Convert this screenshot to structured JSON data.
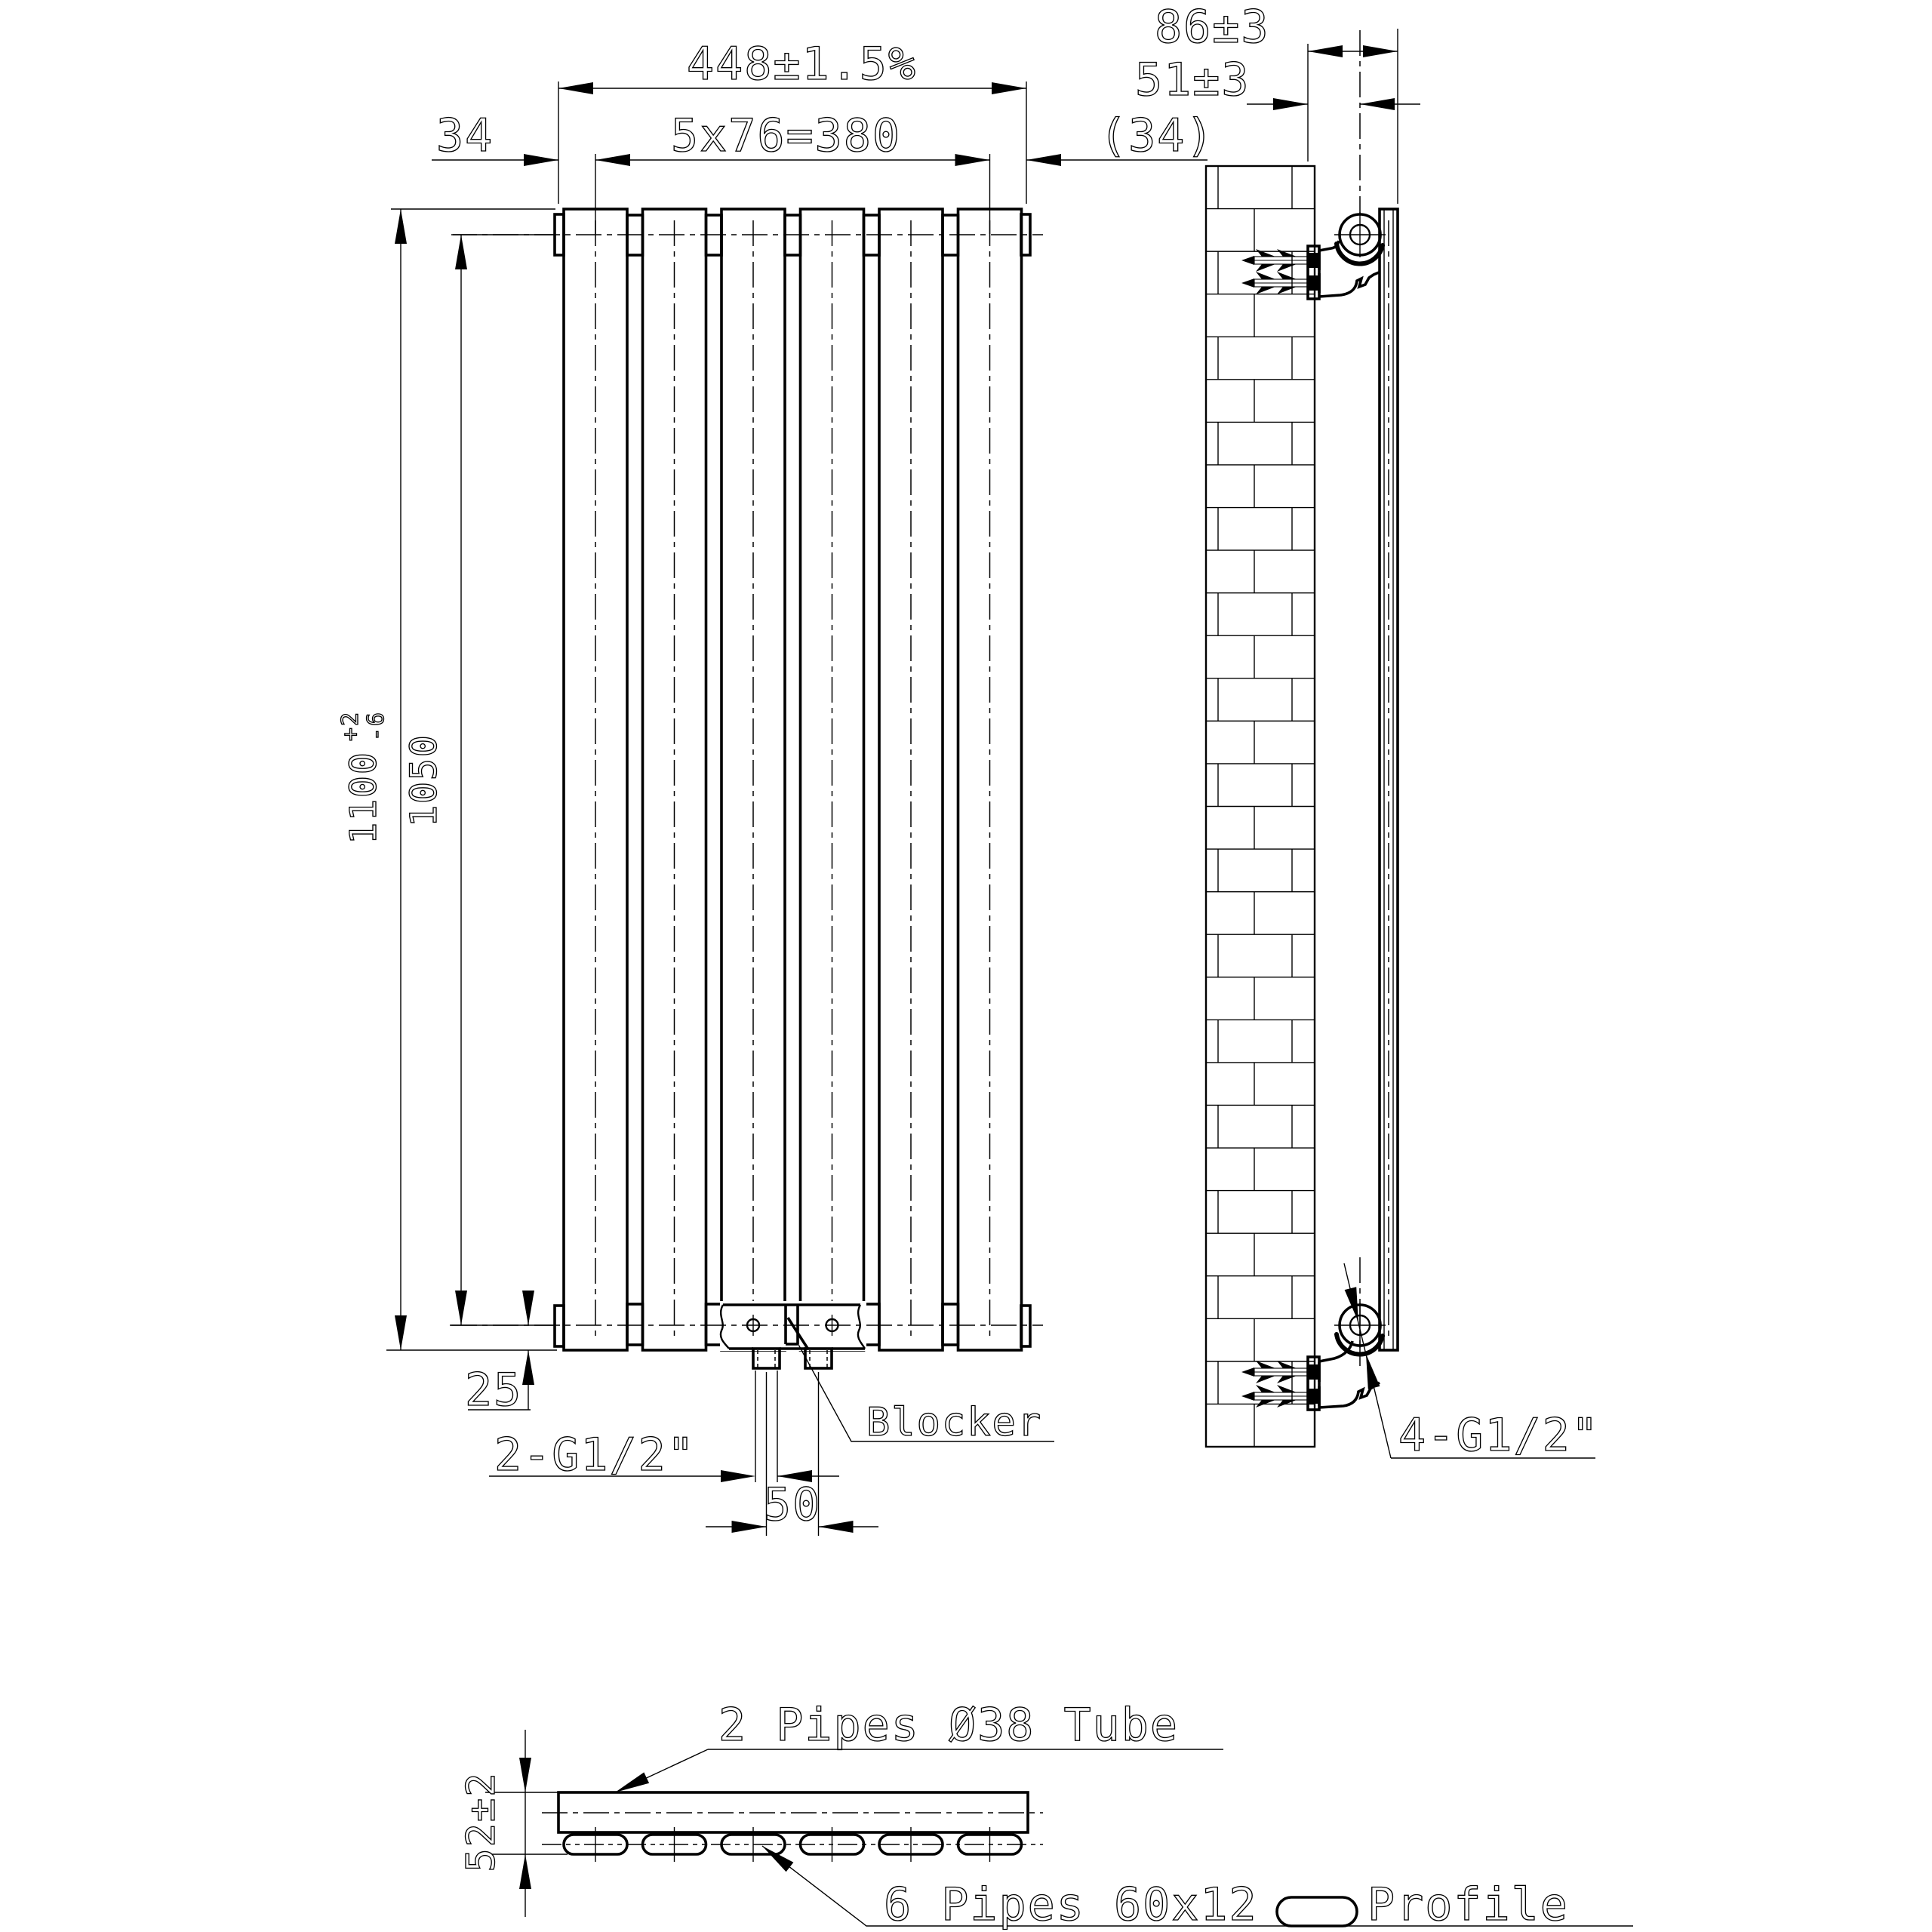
{
  "drawing": {
    "front_view": {
      "width_total": "448±1.5%",
      "offset_left": "34",
      "panel_spacing": "5x76=380",
      "offset_right": "(34)",
      "height_total": "1100",
      "height_tol_plus": "+2",
      "height_tol_minus": "-6",
      "height_centers": "1050",
      "bottom_offset": "25",
      "port_spacing": "50",
      "ports_label": "2-G1/2\"",
      "blocker_label": "Blocker",
      "panel_count": 6
    },
    "side_view": {
      "depth_total": "86±3",
      "wall_to_center": "51±3",
      "connections_label": "4-G1/2\""
    },
    "section_view": {
      "thickness": "52±2",
      "tube_label": "2 Pipes Ø38 Tube",
      "pipes_label": "6 Pipes 60x12",
      "profile_label": "Profile",
      "pipe_count": 6
    },
    "colors": {
      "line": "#000000",
      "background": "#ffffff"
    }
  }
}
